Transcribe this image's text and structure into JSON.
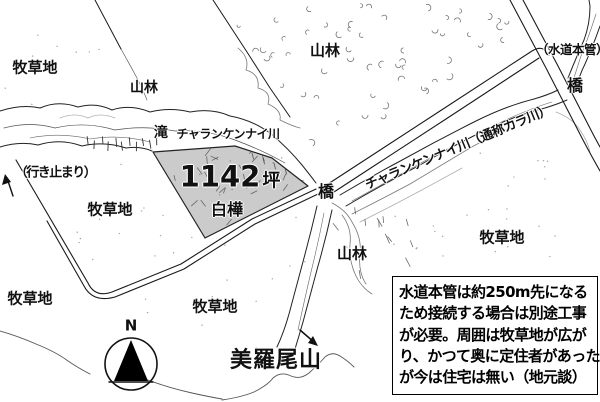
{
  "map": {
    "labels": {
      "pasture": "牧草地",
      "forest": "山林",
      "waterfall": "滝",
      "river": "チャランケンナイ川",
      "river_alias": "チャランケンナイ川（通称カラ川）",
      "dead_end": "（行き止まり）",
      "area_value": "1142",
      "area_unit": "坪",
      "birch": "白樺",
      "bridge": "橋",
      "water_main": "（水道本管）",
      "mountain": "美羅尾山",
      "compass_north": "N"
    },
    "note": {
      "lines": [
        "水道本管は約250m先になる",
        "ため接続する場合は別途工事",
        "が必要。周囲は牧草地が広が",
        "り、かつて奥に定住者があった",
        "が今は住宅は無い（地元談）"
      ]
    },
    "colors": {
      "ink": "#1a1a1a",
      "texture": "#444444",
      "parcel_fill": "#cbcbcb",
      "background": "#ffffff"
    }
  }
}
